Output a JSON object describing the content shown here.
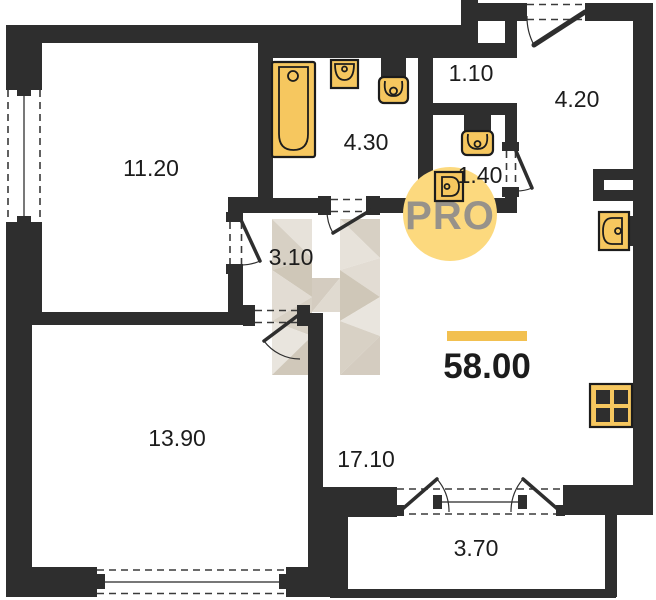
{
  "plan": {
    "rooms": [
      {
        "id": "room-11-20",
        "label": "11.20"
      },
      {
        "id": "bathroom-4-30",
        "label": "4.30"
      },
      {
        "id": "corridor-1-10",
        "label": "1.10"
      },
      {
        "id": "hall-4-20",
        "label": "4.20"
      },
      {
        "id": "wc-1-40",
        "label": "1.40"
      },
      {
        "id": "hallway-3-10",
        "label": "3.10"
      },
      {
        "id": "room-13-90",
        "label": "13.90"
      },
      {
        "id": "living-17-10",
        "label": "17.10"
      },
      {
        "id": "balcony-3-70",
        "label": "3.70"
      }
    ],
    "total_area": {
      "value": "58.00"
    },
    "watermarks": {
      "pro": "PRO",
      "letter": "Н"
    },
    "fixtures": [
      "bathtub",
      "sink",
      "toilet",
      "toilet",
      "sink",
      "kitchen-sink",
      "stove",
      "vent-duct"
    ],
    "colors": {
      "wall": "#2e2e2e",
      "fixture_yellow": "#f6c75f",
      "accent_bar": "#f2c050",
      "pro_circle": "#fcd97e",
      "pro_text": "#97928a",
      "watermark_beige": [
        "#e7e2da",
        "#d7d0c4",
        "#cfc7b8",
        "#e2dcd3"
      ]
    }
  }
}
